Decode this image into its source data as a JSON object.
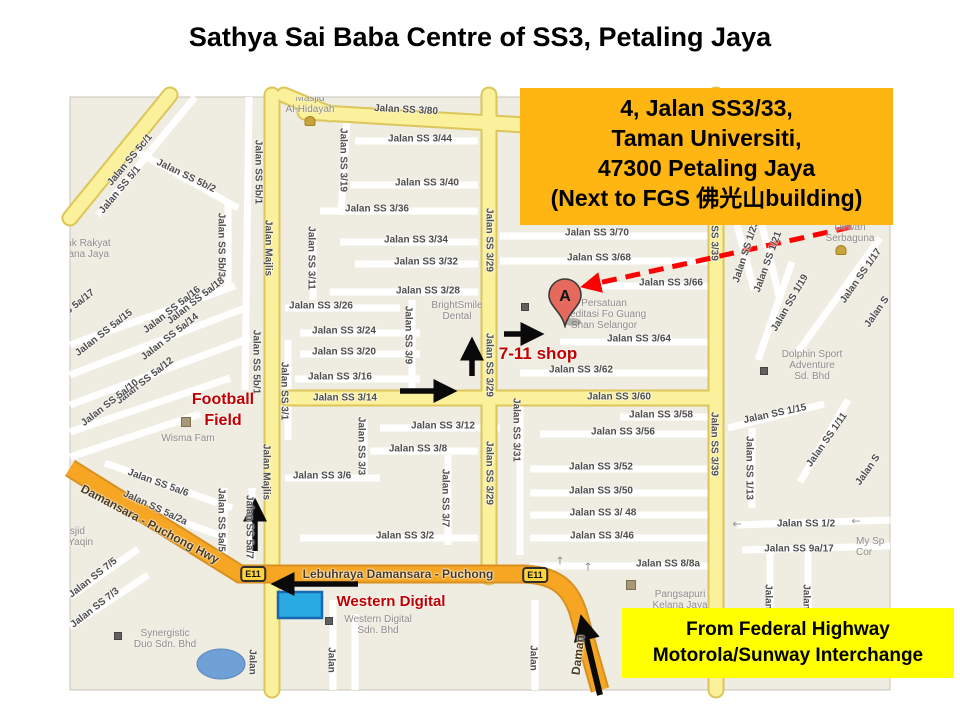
{
  "title": "Sathya Sai Baba Centre of SS3, Petaling Jaya",
  "address_box": {
    "lines": [
      "4, Jalan SS3/33,",
      "Taman Universiti,",
      "47300 Petaling Jaya",
      "(Next to FGS 佛光山building)"
    ],
    "bg": "#FFB612"
  },
  "highway_box": {
    "lines": [
      "From Federal Highway",
      "Motorola/Sunway Interchange"
    ],
    "bg": "#FFFF00"
  },
  "map": {
    "marker": {
      "letter": "A"
    },
    "shield_label": "E11",
    "colors": {
      "land": "#EFECE1",
      "road_white": "#FFFFFF",
      "road_yellow": "#FBF09B",
      "road_orange": "#F6A623",
      "water": "#6FA0D6",
      "annotation_red": "#C00000",
      "route_black": "#0A0A0A",
      "dashed_arrow_red": "#FF0000",
      "marker_fill": "#E56A5D",
      "wd_highlight": "#29ABE2"
    },
    "street_labels": [
      {
        "t": "Jalan SS 5c/1",
        "x": 130,
        "y": 160,
        "r": -50
      },
      {
        "t": "Jalan SS 5/1",
        "x": 120,
        "y": 190,
        "r": -50
      },
      {
        "t": "Jalan SS 5b/2",
        "x": 186,
        "y": 176,
        "r": 26
      },
      {
        "t": "Jalan SS 5b/1",
        "x": 258,
        "y": 172,
        "r": 90
      },
      {
        "t": "Jalan SS 5b/3",
        "x": 221,
        "y": 245,
        "r": 90
      },
      {
        "t": "Jalan Majlis",
        "x": 268,
        "y": 248,
        "r": 90
      },
      {
        "t": "Jalan SS 5b/1",
        "x": 256,
        "y": 362,
        "r": 90
      },
      {
        "t": "Jalan SS 3/19",
        "x": 343,
        "y": 160,
        "r": 90
      },
      {
        "t": "Jalan SS 3/11",
        "x": 311,
        "y": 258,
        "r": 90
      },
      {
        "t": "Jalan SS 3/80",
        "x": 406,
        "y": 110,
        "r": 3
      },
      {
        "t": "Jalan SS 3/44",
        "x": 420,
        "y": 139,
        "r": 0
      },
      {
        "t": "Jalan SS 3/40",
        "x": 427,
        "y": 183,
        "r": 0
      },
      {
        "t": "Jalan SS 3/36",
        "x": 377,
        "y": 209,
        "r": 0
      },
      {
        "t": "Jalan SS 3/34",
        "x": 416,
        "y": 240,
        "r": 0
      },
      {
        "t": "Jalan SS 3/32",
        "x": 426,
        "y": 262,
        "r": 0
      },
      {
        "t": "Jalan SS 3/28",
        "x": 428,
        "y": 291,
        "r": 0
      },
      {
        "t": "Jalan SS 3/26",
        "x": 321,
        "y": 306,
        "r": 0
      },
      {
        "t": "Jalan SS 3/24",
        "x": 344,
        "y": 331,
        "r": 0
      },
      {
        "t": "Jalan SS 3/20",
        "x": 344,
        "y": 352,
        "r": 0
      },
      {
        "t": "Jalan SS 3/16",
        "x": 340,
        "y": 377,
        "r": 0
      },
      {
        "t": "Jalan SS 3/14",
        "x": 345,
        "y": 398,
        "r": 0
      },
      {
        "t": "Jalan SS 3/9",
        "x": 408,
        "y": 335,
        "r": 90
      },
      {
        "t": "Jalan SS 3/29",
        "x": 489,
        "y": 240,
        "r": 90
      },
      {
        "t": "Jalan SS 3/29",
        "x": 489,
        "y": 365,
        "r": 90
      },
      {
        "t": "Jalan SS 3/29",
        "x": 489,
        "y": 473,
        "r": 90
      },
      {
        "t": "Jalan SS 3/12",
        "x": 443,
        "y": 426,
        "r": 0
      },
      {
        "t": "Jalan SS 3/8",
        "x": 418,
        "y": 449,
        "r": 0
      },
      {
        "t": "Jalan SS 3/6",
        "x": 322,
        "y": 476,
        "r": 0
      },
      {
        "t": "Jalan SS 3/3",
        "x": 361,
        "y": 446,
        "r": 90
      },
      {
        "t": "Jalan SS 3/7",
        "x": 445,
        "y": 498,
        "r": 90
      },
      {
        "t": "Jalan SS 3/2",
        "x": 405,
        "y": 536,
        "r": 0
      },
      {
        "t": "Jalan SS 3/31",
        "x": 516,
        "y": 430,
        "r": 90
      },
      {
        "t": "Jalan SS 3/1",
        "x": 284,
        "y": 391,
        "r": 90
      },
      {
        "t": "Jalan SS 5a/18",
        "x": 196,
        "y": 301,
        "r": -38
      },
      {
        "t": "Jalan SS 5a/16",
        "x": 172,
        "y": 310,
        "r": -38
      },
      {
        "t": "Jalan SS 5a/17",
        "x": 66,
        "y": 313,
        "r": -38
      },
      {
        "t": "Jalan SS 5a/15",
        "x": 104,
        "y": 333,
        "r": -38
      },
      {
        "t": "Jalan SS 5a/14",
        "x": 170,
        "y": 337,
        "r": -38
      },
      {
        "t": "Jalan SS 5a/12",
        "x": 145,
        "y": 381,
        "r": -38
      },
      {
        "t": "Jalan SS 5a/10",
        "x": 110,
        "y": 403,
        "r": -38
      },
      {
        "t": "Jalan Majlis",
        "x": 266,
        "y": 472,
        "r": 90
      },
      {
        "t": "Jalan SS 5a/6",
        "x": 158,
        "y": 483,
        "r": 20
      },
      {
        "t": "Jalan SS 5a/2a",
        "x": 155,
        "y": 508,
        "r": 25
      },
      {
        "t": "Damansara - Puchong Hwy",
        "x": 150,
        "y": 524,
        "r": 28,
        "h": 1
      },
      {
        "t": "Jalan SS 7/5",
        "x": 93,
        "y": 578,
        "r": -38
      },
      {
        "t": "Jalan SS 7/3",
        "x": 95,
        "y": 608,
        "r": -38
      },
      {
        "t": "Jalan SS 5a/5",
        "x": 221,
        "y": 520,
        "r": 90
      },
      {
        "t": "Jalan SS 5a/7",
        "x": 249,
        "y": 527,
        "r": 90
      },
      {
        "t": "Lebuhraya Damansara - Puchong",
        "x": 398,
        "y": 574,
        "r": 0,
        "h": 1
      },
      {
        "t": "Jalan",
        "x": 252,
        "y": 662,
        "r": 90
      },
      {
        "t": "Jalan",
        "x": 331,
        "y": 660,
        "r": 90
      },
      {
        "t": "Jalan",
        "x": 533,
        "y": 658,
        "r": 90
      },
      {
        "t": "Daman",
        "x": 578,
        "y": 655,
        "r": -83,
        "h": 1
      },
      {
        "t": "Jalan SS 3/70",
        "x": 597,
        "y": 233,
        "r": 0
      },
      {
        "t": "Jalan SS 3/68",
        "x": 599,
        "y": 258,
        "r": 0
      },
      {
        "t": "Jalan SS 3/66",
        "x": 671,
        "y": 283,
        "r": 0
      },
      {
        "t": "Jalan SS 3/64",
        "x": 639,
        "y": 339,
        "r": 0
      },
      {
        "t": "Jalan SS 3/62",
        "x": 581,
        "y": 370,
        "r": 0
      },
      {
        "t": "Jalan SS 3/60",
        "x": 619,
        "y": 397,
        "r": 0
      },
      {
        "t": "Jalan SS 3/58",
        "x": 661,
        "y": 415,
        "r": 0
      },
      {
        "t": "Jalan SS 3/56",
        "x": 623,
        "y": 432,
        "r": 0
      },
      {
        "t": "Jalan SS 3/52",
        "x": 601,
        "y": 467,
        "r": 0
      },
      {
        "t": "Jalan SS 3/50",
        "x": 601,
        "y": 491,
        "r": 0
      },
      {
        "t": "Jalan SS 3/ 48",
        "x": 603,
        "y": 513,
        "r": 0
      },
      {
        "t": "Jalan SS 3/46",
        "x": 602,
        "y": 536,
        "r": 0
      },
      {
        "t": "Jalan SS 8/8a",
        "x": 668,
        "y": 564,
        "r": 0
      },
      {
        "t": "SS 3/39",
        "x": 714,
        "y": 243,
        "r": 90
      },
      {
        "t": "Jalan SS 3/39",
        "x": 714,
        "y": 444,
        "r": 90
      },
      {
        "t": "Jalan SS 1/23",
        "x": 746,
        "y": 252,
        "r": -72
      },
      {
        "t": "Jalan SS 1/21",
        "x": 768,
        "y": 262,
        "r": -70
      },
      {
        "t": "Jalan SS 1/19",
        "x": 790,
        "y": 303,
        "r": -60
      },
      {
        "t": "Jalan SS 1/17",
        "x": 861,
        "y": 276,
        "r": -55
      },
      {
        "t": "Jalan S",
        "x": 877,
        "y": 312,
        "r": -55
      },
      {
        "t": "Jalan SS 1/15",
        "x": 775,
        "y": 414,
        "r": -12
      },
      {
        "t": "Jalan SS 1/11",
        "x": 827,
        "y": 440,
        "r": -55
      },
      {
        "t": "Jalan SS 1/13",
        "x": 749,
        "y": 468,
        "r": 90
      },
      {
        "t": "Jalan S",
        "x": 868,
        "y": 470,
        "r": -55
      },
      {
        "t": "Jalan SS 1/2",
        "x": 806,
        "y": 524,
        "r": 0
      },
      {
        "t": "Jalan SS 9a/17",
        "x": 799,
        "y": 549,
        "r": 0
      },
      {
        "t": "Jalan",
        "x": 768,
        "y": 597,
        "r": 90
      },
      {
        "t": "Jalan",
        "x": 806,
        "y": 597,
        "r": 90
      }
    ],
    "poi_labels": [
      {
        "lines": [
          "Masjid",
          "Al-Hidayah"
        ],
        "x": 310,
        "y": 93
      },
      {
        "lines": [
          "Bank Rakyat",
          "Kelana Jaya"
        ],
        "x": 54,
        "y": 238,
        "a": "l"
      },
      {
        "lines": [
          "BrightSmile",
          "Dental"
        ],
        "x": 457,
        "y": 300
      },
      {
        "lines": [
          "Persatuan",
          "Meditasi Fo Guang",
          "Shan Selangor"
        ],
        "x": 604,
        "y": 298
      },
      {
        "lines": [
          "Wisma Fam"
        ],
        "x": 188,
        "y": 433
      },
      {
        "lines": [
          "Western Digital",
          "Sdn. Bhd"
        ],
        "x": 378,
        "y": 614
      },
      {
        "lines": [
          "Synergistic",
          "Duo Sdn. Bhd"
        ],
        "x": 165,
        "y": 628
      },
      {
        "lines": [
          "Masjid",
          "Al-Yaqin"
        ],
        "x": 56,
        "y": 526,
        "a": "l"
      },
      {
        "lines": [
          "Dewan",
          "Serbaguna"
        ],
        "x": 850,
        "y": 222
      },
      {
        "lines": [
          "Dolphin Sport",
          "Adventure",
          "Sd. Bhd"
        ],
        "x": 812,
        "y": 349
      },
      {
        "lines": [
          "Pangsapuri",
          "Kelana Jaya"
        ],
        "x": 680,
        "y": 589
      },
      {
        "lines": [
          "My Sp",
          "Cor"
        ],
        "x": 856,
        "y": 536,
        "a": "l"
      }
    ],
    "poi_icons": [
      {
        "type": "mosque",
        "x": 310,
        "y": 121
      },
      {
        "type": "mosque",
        "x": 841,
        "y": 250
      },
      {
        "type": "building",
        "x": 186,
        "y": 422
      },
      {
        "type": "building",
        "x": 631,
        "y": 585
      },
      {
        "type": "dot",
        "x": 764,
        "y": 371
      },
      {
        "type": "dot",
        "x": 329,
        "y": 621
      },
      {
        "type": "dot",
        "x": 525,
        "y": 307
      },
      {
        "type": "dot",
        "x": 118,
        "y": 636
      }
    ],
    "red_labels": [
      {
        "lines": [
          "Football",
          "Field"
        ],
        "x": 223,
        "y": 390,
        "size": 16
      },
      {
        "lines": [
          "7-11 shop"
        ],
        "x": 538,
        "y": 343,
        "size": 17
      },
      {
        "lines": [
          "Western Digital"
        ],
        "x": 391,
        "y": 592,
        "size": 15
      }
    ],
    "mini_arrows": [
      {
        "g": "←",
        "x": 737,
        "y": 524
      },
      {
        "g": "←",
        "x": 856,
        "y": 521
      },
      {
        "g": "↑",
        "x": 560,
        "y": 561
      },
      {
        "g": "↑",
        "x": 588,
        "y": 567
      }
    ],
    "shields": [
      {
        "x": 253,
        "y": 574
      },
      {
        "x": 535,
        "y": 575
      }
    ]
  }
}
